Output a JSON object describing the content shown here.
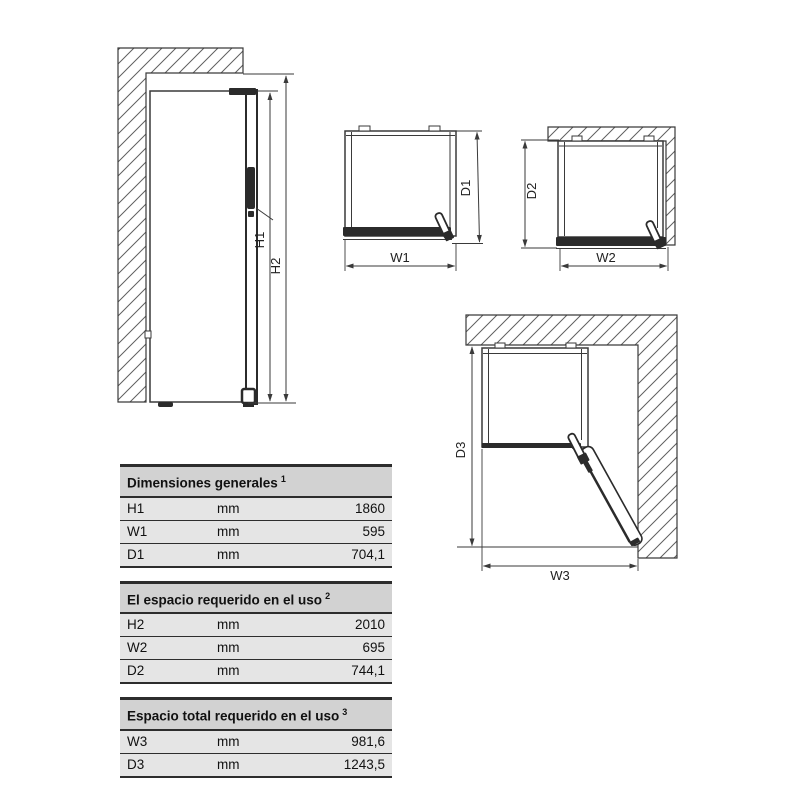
{
  "diagram": {
    "labels": {
      "h1": "H1",
      "h2": "H2",
      "w1": "W1",
      "d1": "D1",
      "w2": "W2",
      "d2": "D2",
      "w3": "W3",
      "d3": "D3"
    }
  },
  "tables": [
    {
      "title": "Dimensiones generales",
      "superscript": "1",
      "rows": [
        {
          "label": "H1",
          "unit": "mm",
          "value": "1860"
        },
        {
          "label": "W1",
          "unit": "mm",
          "value": "595"
        },
        {
          "label": "D1",
          "unit": "mm",
          "value": "704,1"
        }
      ]
    },
    {
      "title": "El espacio requerido en el uso",
      "superscript": "2",
      "rows": [
        {
          "label": "H2",
          "unit": "mm",
          "value": "2010"
        },
        {
          "label": "W2",
          "unit": "mm",
          "value": "695"
        },
        {
          "label": "D2",
          "unit": "mm",
          "value": "744,1"
        }
      ]
    },
    {
      "title": "Espacio total requerido en el uso",
      "superscript": "3",
      "rows": [
        {
          "label": "W3",
          "unit": "mm",
          "value": "981,6"
        },
        {
          "label": "D3",
          "unit": "mm",
          "value": "1243,5"
        }
      ]
    }
  ],
  "colors": {
    "line": "#3a3a3a",
    "dark_fill": "#2b2b2b",
    "hatch": "#5f5f5f",
    "table_header_bg": "#d2d2d2",
    "table_row_bg": "#e5e5e5",
    "table_border": "#2d2d2d",
    "text": "#111111"
  }
}
